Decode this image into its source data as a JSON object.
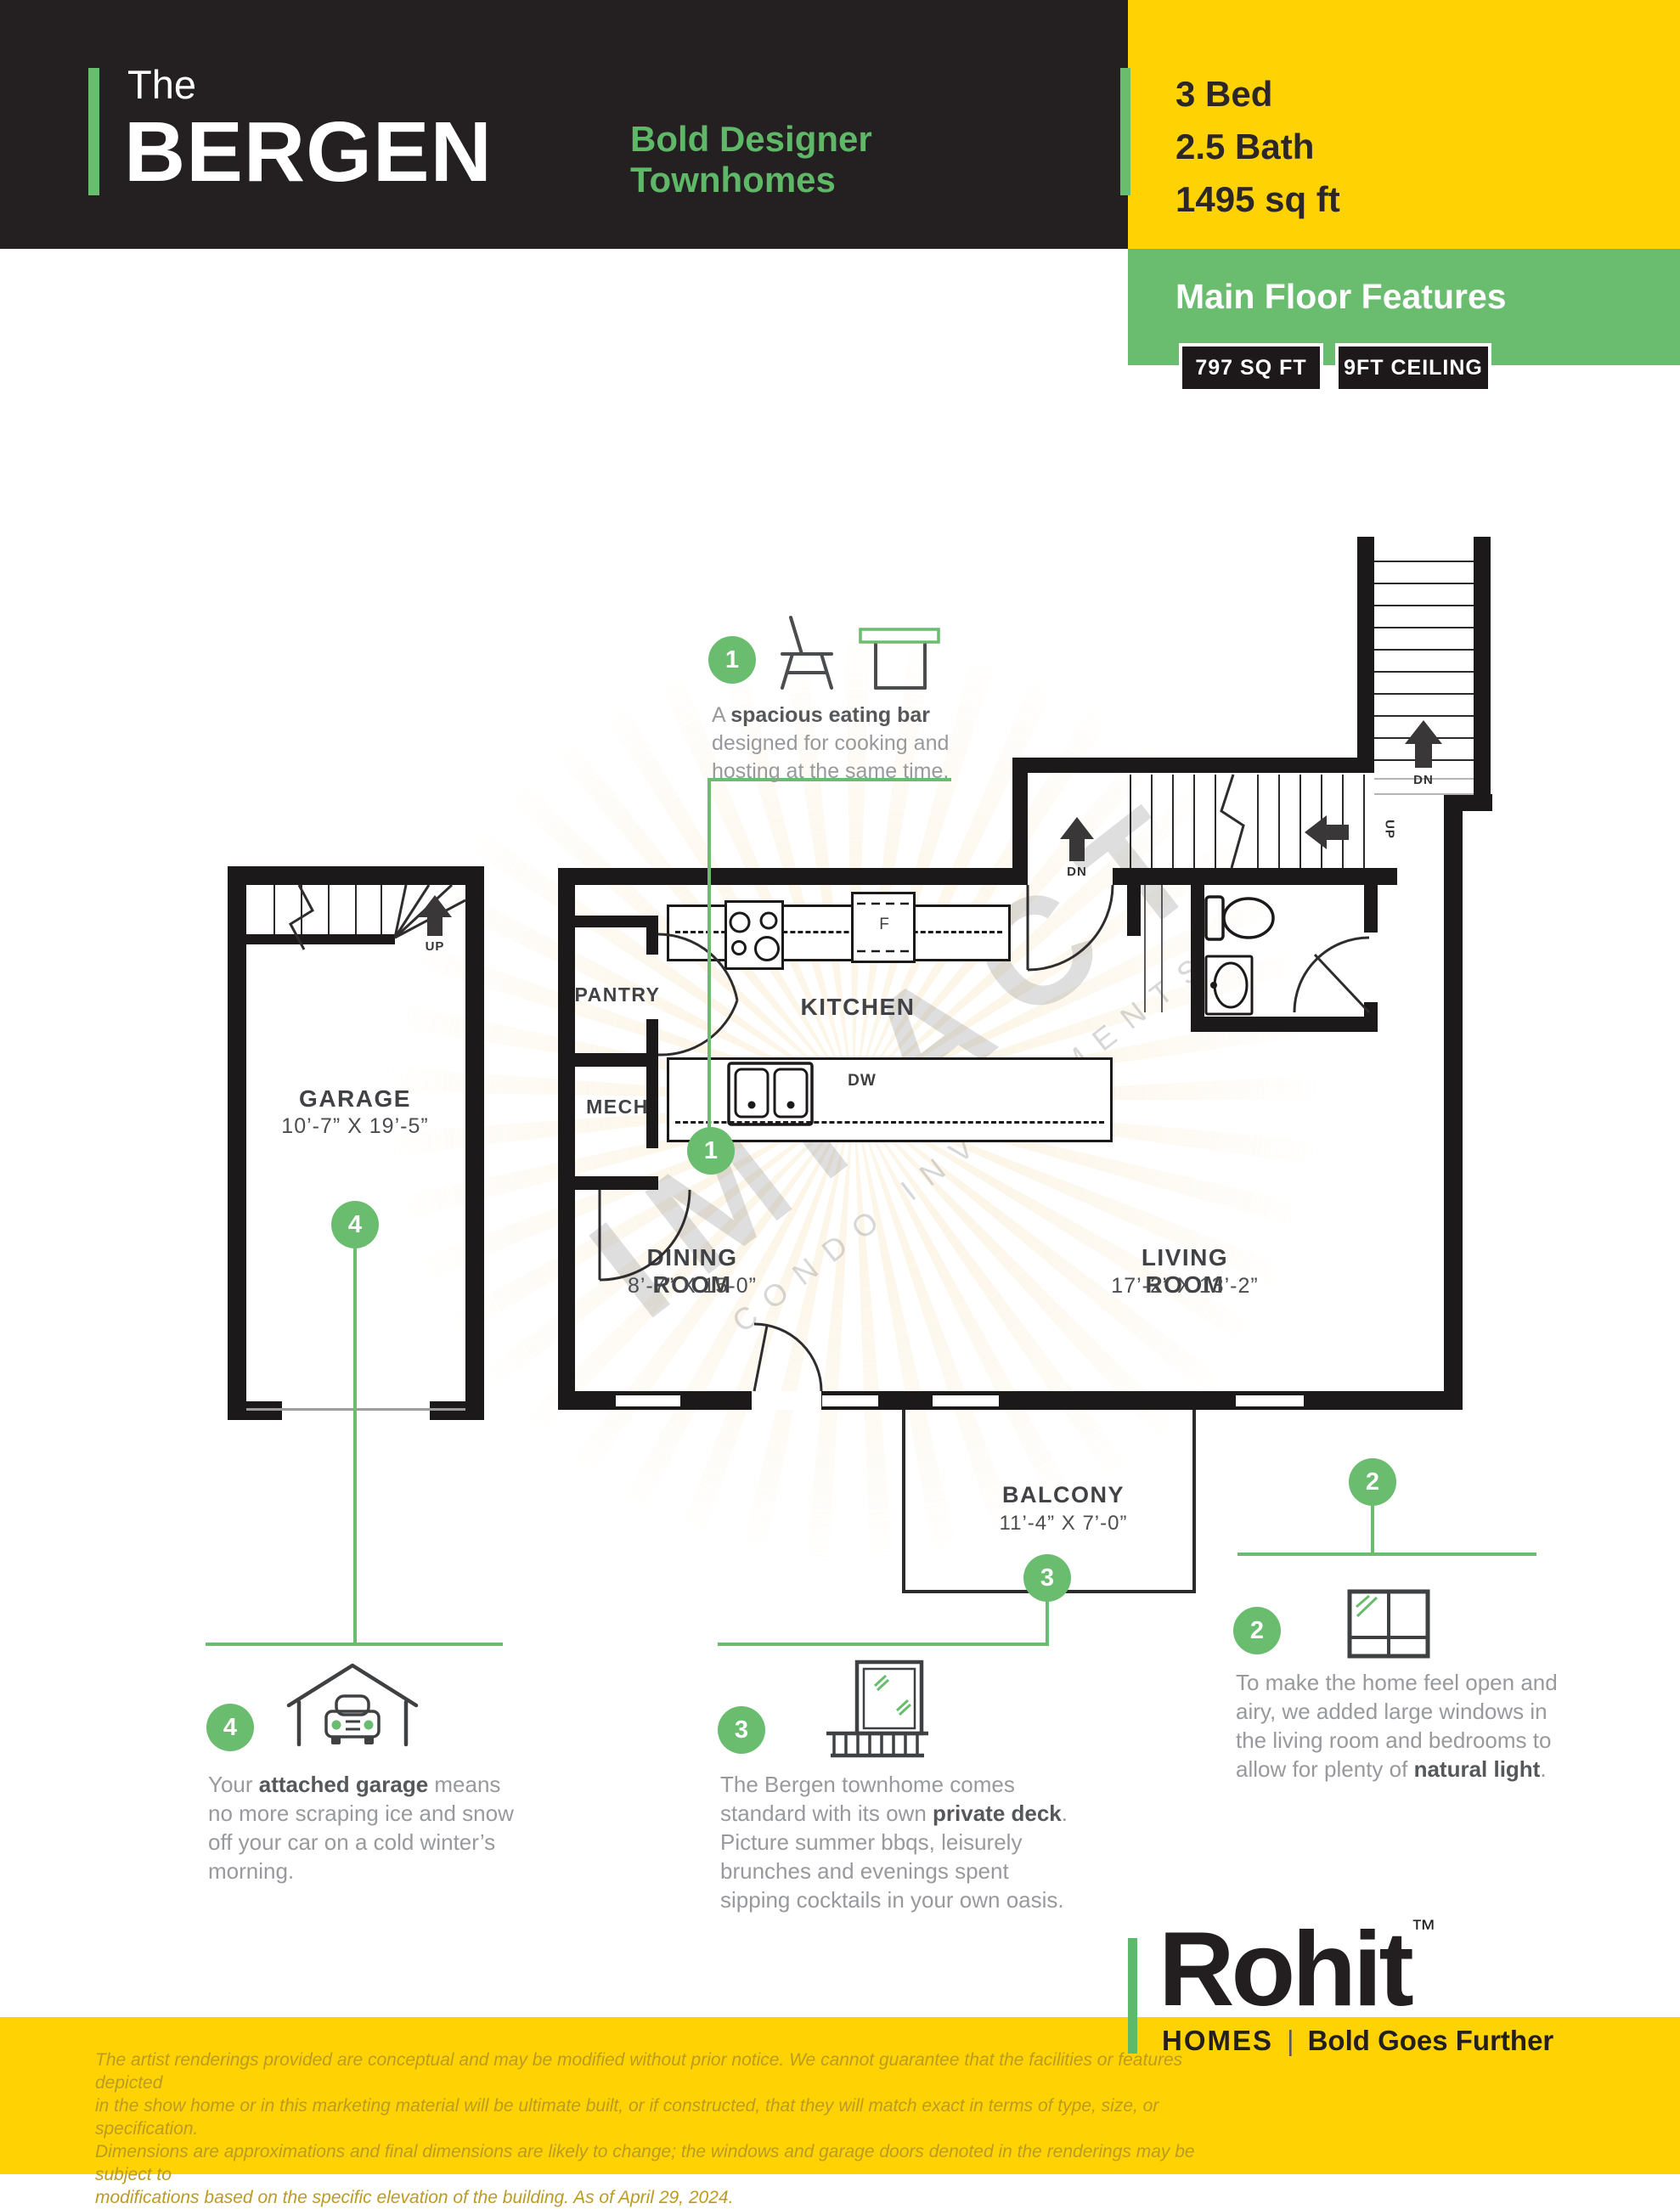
{
  "colors": {
    "yellow": "#ffd204",
    "green": "#6abc6f",
    "dark": "#242021"
  },
  "header": {
    "prefix": "The",
    "name": "BERGEN",
    "tagline1": "Bold Designer",
    "tagline2": "Townhomes",
    "stats": [
      "3 Bed",
      "2.5 Bath",
      "1495 sq ft"
    ],
    "section_title": "Main Floor Features",
    "badge1": "797 SQ FT",
    "badge2": "9FT CEILING"
  },
  "plan": {
    "garage": {
      "name": "GARAGE",
      "dim": "10’-7” X 19’-5”"
    },
    "pantry": "PANTRY",
    "mech": "MECH",
    "kitchen": "KITCHEN",
    "dining": {
      "name": "DINING ROOM",
      "dim": "8’-7” X 15-0”"
    },
    "living": {
      "name": "LIVING ROOM",
      "dim": "17’-2” X 13’-2”"
    },
    "balcony": {
      "name": "BALCONY",
      "dim": "11’-4” X 7’-0”"
    },
    "up": "UP",
    "dn": "DN",
    "fridge": "F",
    "dw": "DW",
    "watermark1": "IMPACT",
    "watermark2": "CONDO INVESTMENTS"
  },
  "callouts": [
    {
      "num": "1",
      "lines": [
        {
          "pre": "A ",
          "bold": "spacious eating bar",
          "post": ""
        },
        {
          "pre": "designed for cooking and",
          "bold": "",
          "post": ""
        },
        {
          "pre": "hosting at the same time.",
          "bold": "",
          "post": ""
        }
      ]
    },
    {
      "num": "2",
      "lines": [
        {
          "pre": "To make the home feel open and",
          "bold": "",
          "post": ""
        },
        {
          "pre": "airy, we added large windows in",
          "bold": "",
          "post": ""
        },
        {
          "pre": "the living room and bedrooms to",
          "bold": "",
          "post": ""
        },
        {
          "pre": "allow for plenty of ",
          "bold": "natural light",
          "post": "."
        }
      ]
    },
    {
      "num": "3",
      "lines": [
        {
          "pre": "The Bergen townhome comes",
          "bold": "",
          "post": ""
        },
        {
          "pre": "standard with its own ",
          "bold": "private deck",
          "post": "."
        },
        {
          "pre": "Picture summer bbqs, leisurely",
          "bold": "",
          "post": ""
        },
        {
          "pre": "brunches and evenings spent",
          "bold": "",
          "post": ""
        },
        {
          "pre": "sipping cocktails in your own oasis.",
          "bold": "",
          "post": ""
        }
      ]
    },
    {
      "num": "4",
      "lines": [
        {
          "pre": "Your ",
          "bold": "attached garage",
          "post": " means"
        },
        {
          "pre": "no more scraping ice and snow",
          "bold": "",
          "post": ""
        },
        {
          "pre": "off your car on a cold winter’s",
          "bold": "",
          "post": ""
        },
        {
          "pre": "morning.",
          "bold": "",
          "post": ""
        }
      ]
    }
  ],
  "footer": {
    "lines": [
      "The artist renderings provided are conceptual and may be modified without prior notice. We cannot guarantee that the facilities or features depicted",
      "in the show home or in this marketing material will be ultimate built, or if constructed, that they will match exact in terms of type, size, or specification.",
      "Dimensions are approximations and final dimensions are likely to change; the windows and garage doors denoted in the renderings may be subject to",
      "modifications based on the specific elevation of the building.  As of April 29, 2024."
    ],
    "logo": {
      "name": "Rohit",
      "tm": "™",
      "homes": "HOMES",
      "divider": "|",
      "slogan": "Bold Goes Further"
    }
  }
}
